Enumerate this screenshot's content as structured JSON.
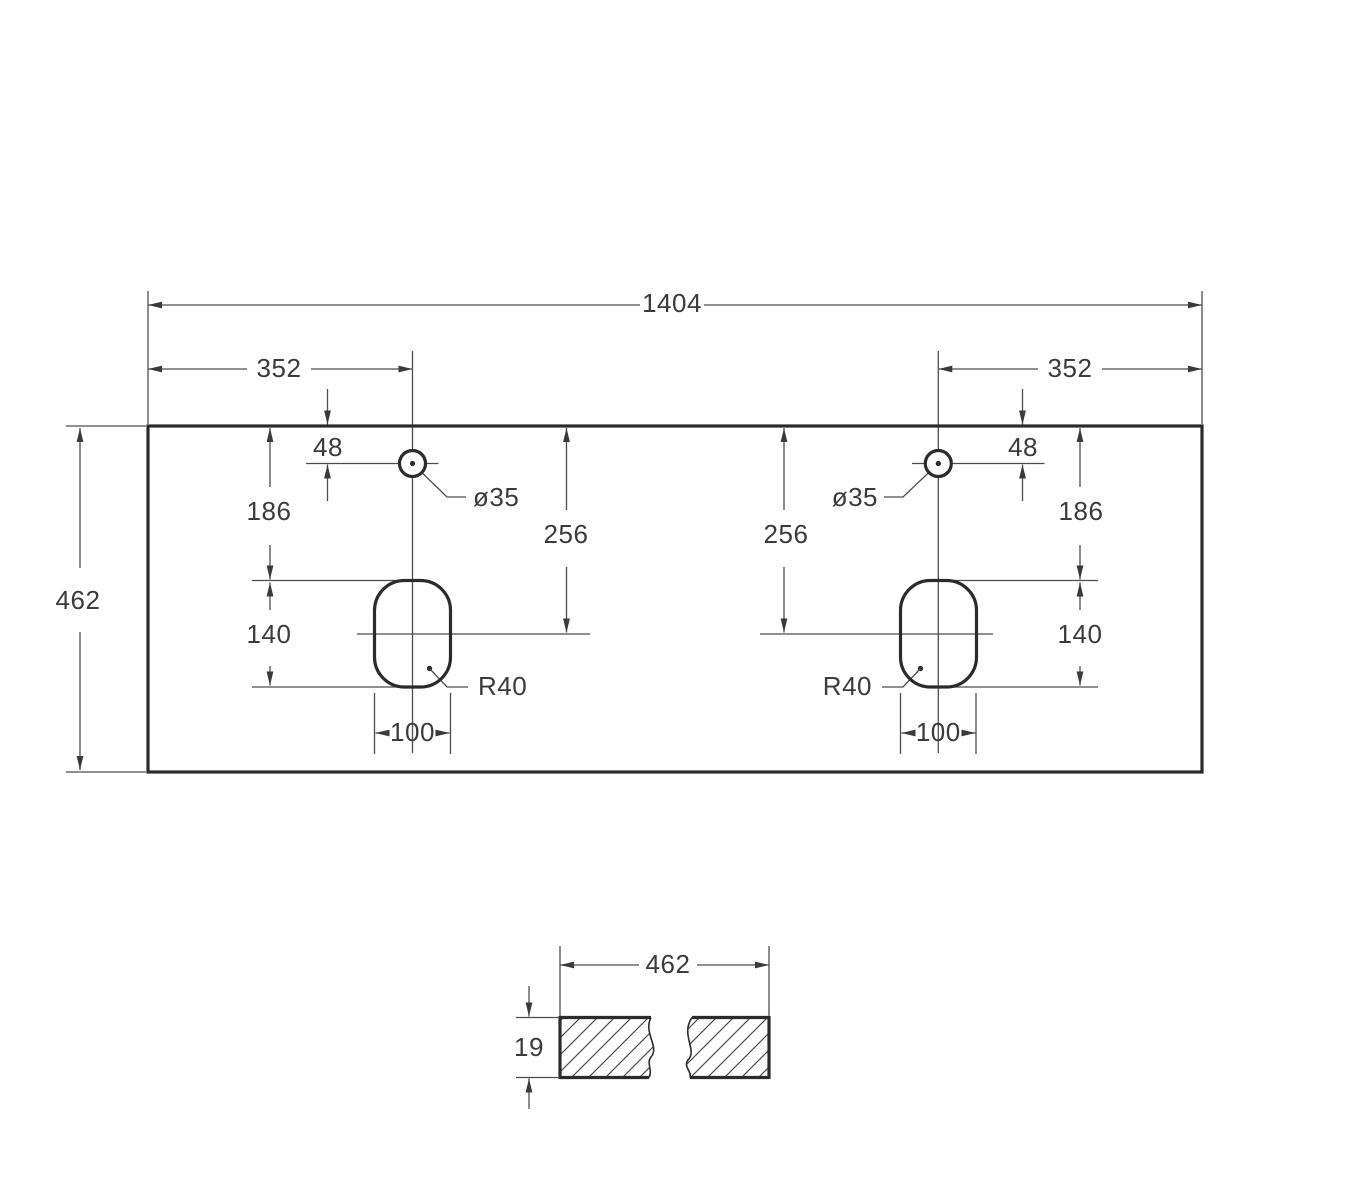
{
  "plan_view": {
    "overall_width": "1404",
    "depth": "462",
    "left_hole_offset": "352",
    "right_hole_offset": "352",
    "left_group": {
      "hole_from_top": "48",
      "hole_diameter": "ø35",
      "top_to_cutout": "186",
      "top_to_cutout_center": "256",
      "cutout_length": "140",
      "cutout_width": "100",
      "corner_radius": "R40"
    },
    "right_group": {
      "hole_from_top": "48",
      "hole_diameter": "ø35",
      "top_to_cutout": "186",
      "top_to_cutout_center": "256",
      "cutout_length": "140",
      "cutout_width": "100",
      "corner_radius": "R40"
    }
  },
  "section_view": {
    "width": "462",
    "thickness": "19"
  },
  "colors": {
    "outline": "#2b2b2b",
    "dimension_lines": "#4d4d4d",
    "text": "#3b3b3b",
    "background": "#ffffff"
  }
}
